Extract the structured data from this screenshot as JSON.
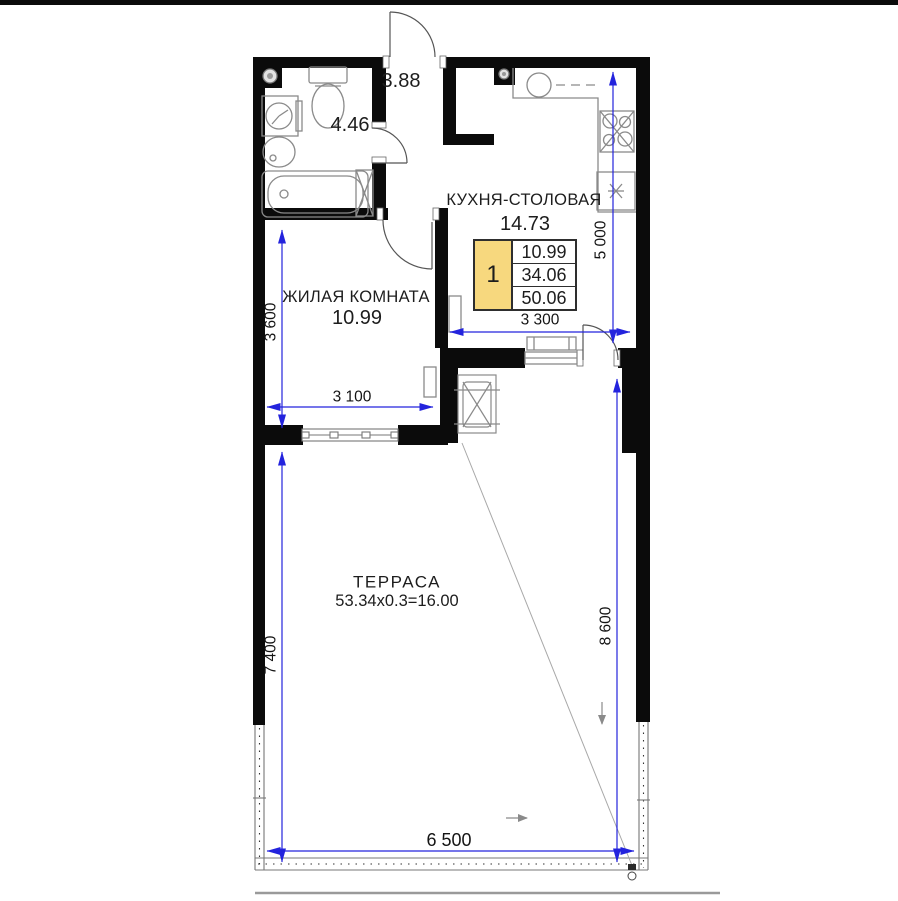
{
  "plan": {
    "type": "apartment-floor-plan",
    "rooms": {
      "hall": {
        "area": "3.88"
      },
      "bathroom": {
        "area": "4.46"
      },
      "kitchen": {
        "name": "КУХНЯ-СТОЛОВАЯ",
        "area": "14.73"
      },
      "living": {
        "name": "ЖИЛАЯ КОМНАТА",
        "area": "10.99"
      },
      "terrace": {
        "name": "ТЕРРАСА",
        "calc": "53.34x0.3=16.00"
      }
    },
    "info_box": {
      "rooms_count": "1",
      "living_area": "10.99",
      "area": "34.06",
      "total_area": "50.06"
    },
    "dimensions": {
      "kitchen_height": "5 000",
      "kitchen_width": "3 300",
      "living_height": "3 600",
      "living_width": "3 100",
      "terrace_left_height": "7 400",
      "terrace_right_height": "8 600",
      "terrace_width": "6 500"
    },
    "colors": {
      "wall": "#0b0b0b",
      "dimension_line": "#2323dd",
      "dimension_text": "#141414",
      "info_highlight": "#f7d87e",
      "fixture_outline": "#8a8a8a"
    }
  }
}
